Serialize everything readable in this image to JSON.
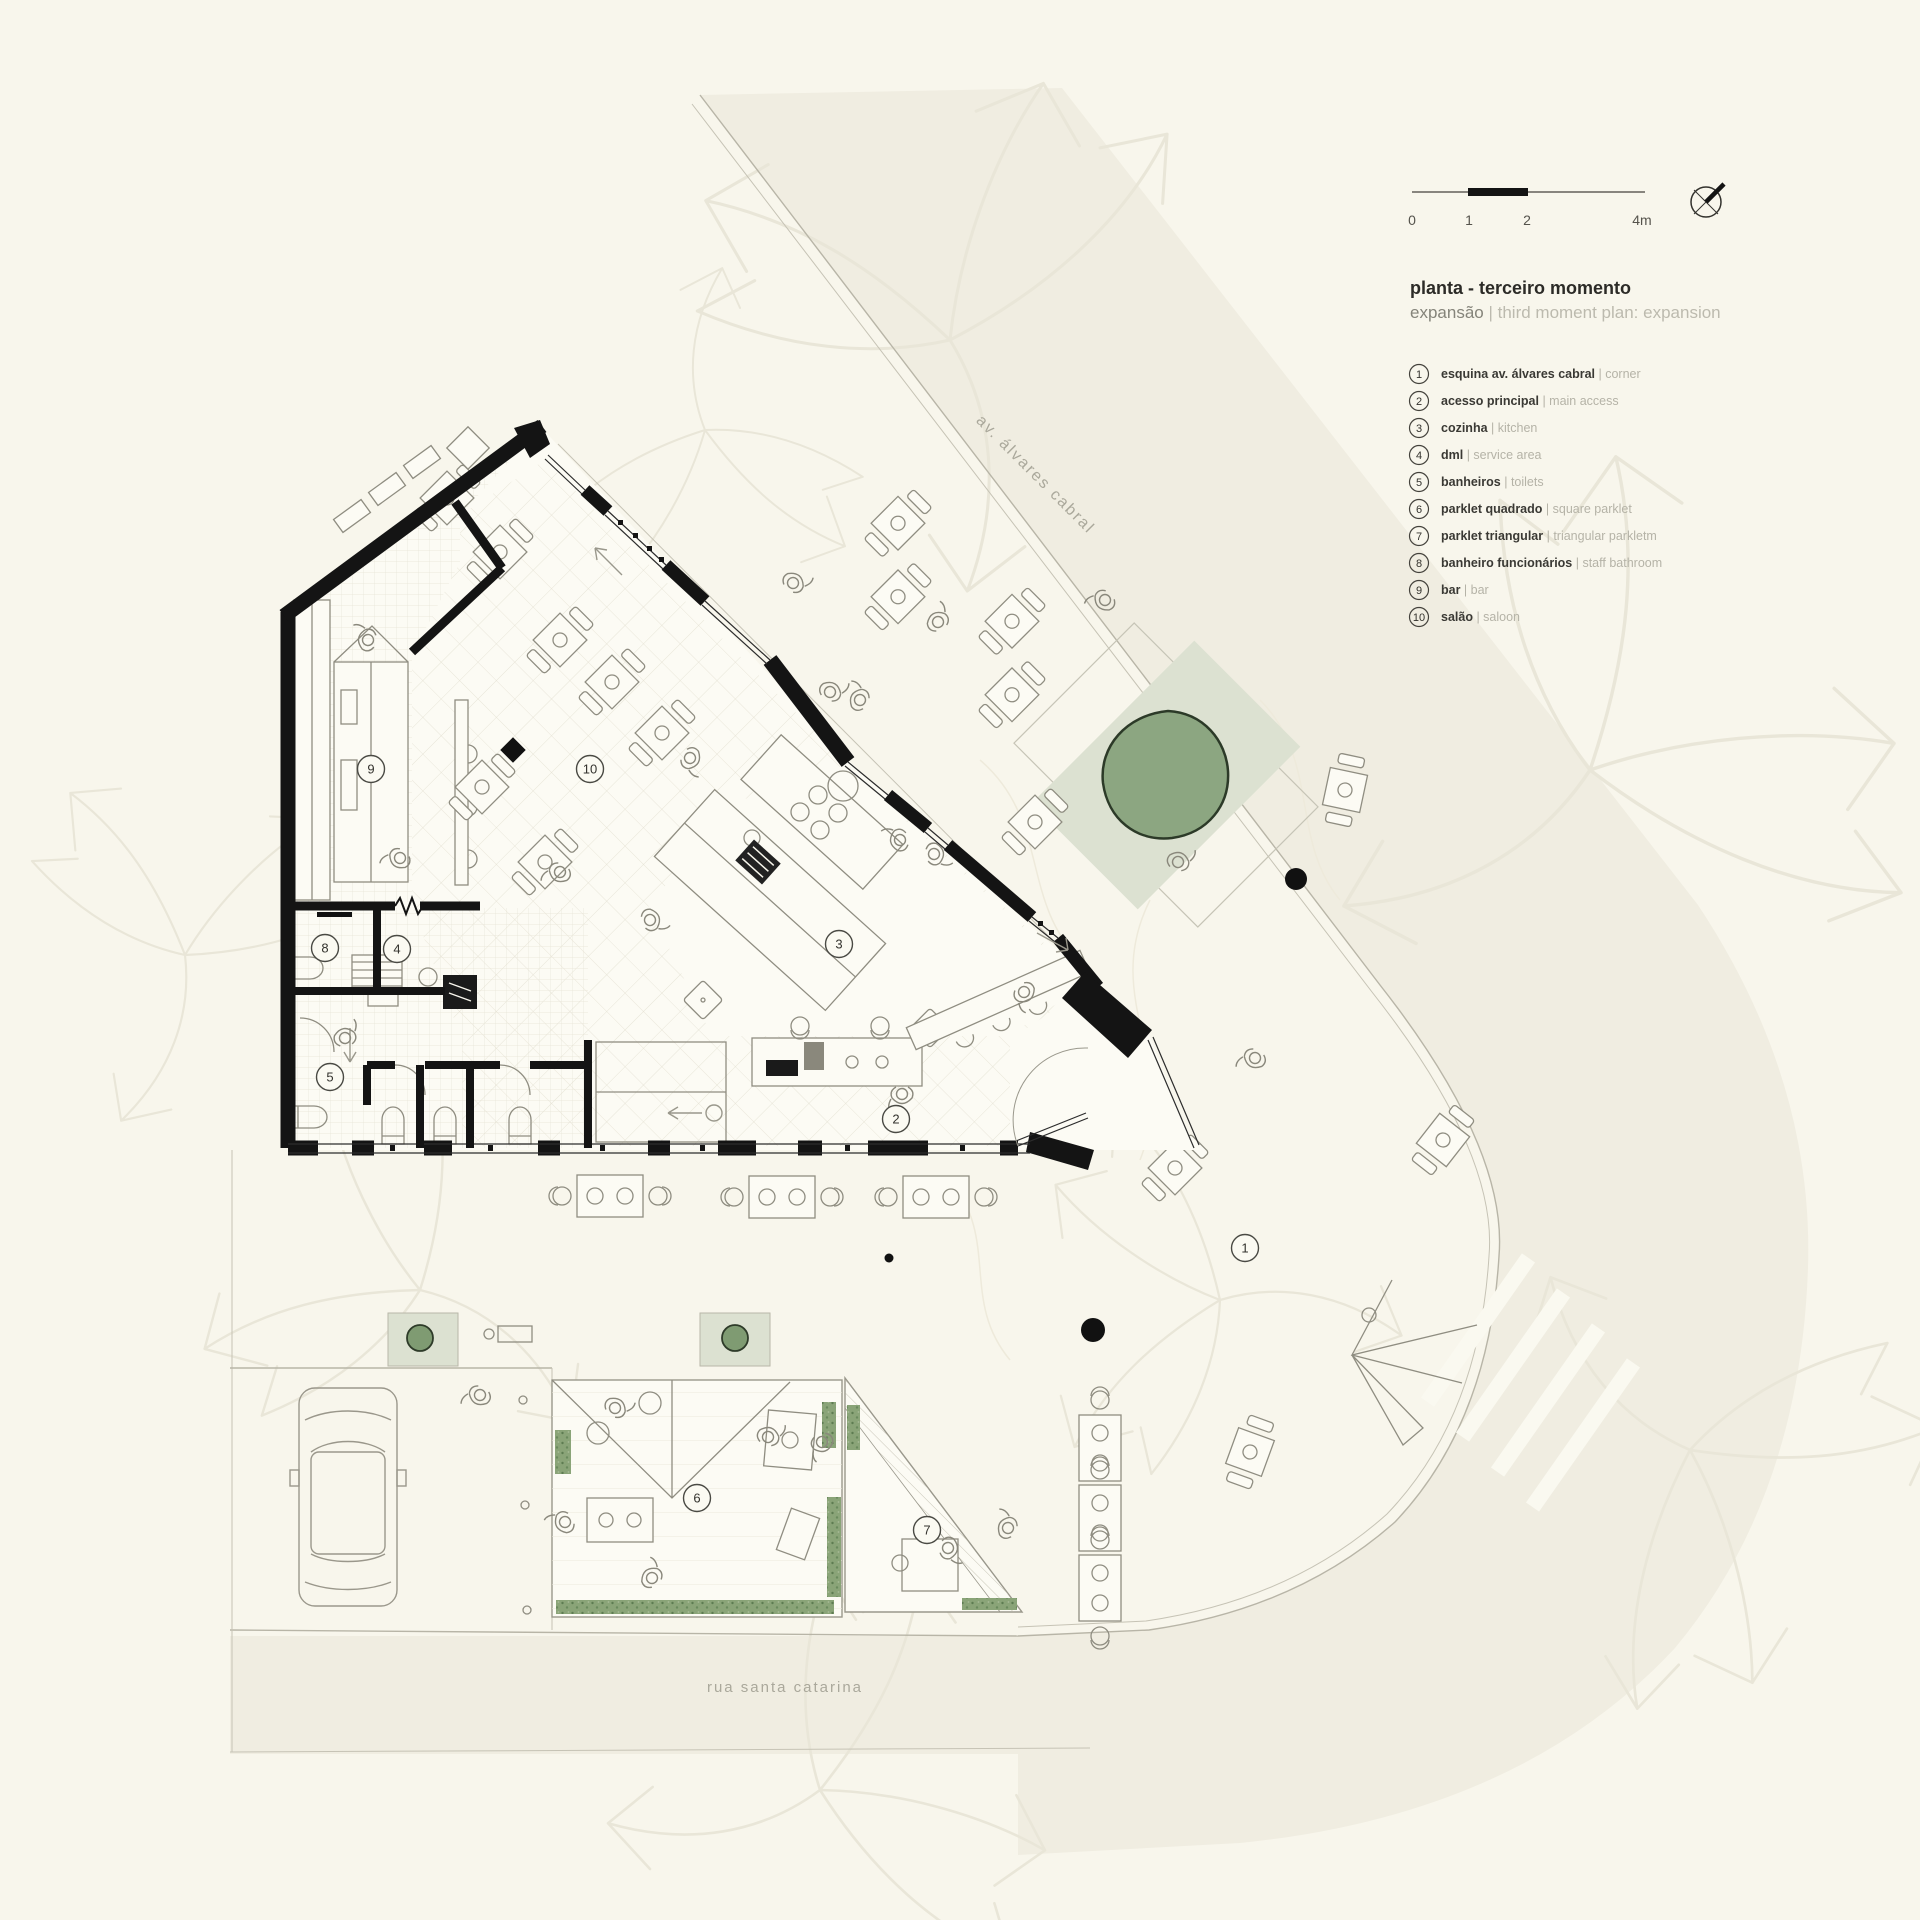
{
  "title_block": {
    "title": "planta - terceiro momento",
    "subtitle_pt": "expansão",
    "subtitle_sep": " | ",
    "subtitle_en": "third moment plan: expansion"
  },
  "scale_bar": {
    "labels": [
      "0",
      "1",
      "2",
      "4m"
    ]
  },
  "compass": {
    "name": "north-indicator"
  },
  "streets": {
    "avenue": "av. álvares cabral",
    "street": "rua santa catarina"
  },
  "legend": {
    "items": [
      {
        "num": "1",
        "pt": "esquina av. álvares cabral",
        "en": "corner"
      },
      {
        "num": "2",
        "pt": "acesso principal",
        "en": "main access"
      },
      {
        "num": "3",
        "pt": "cozinha",
        "en": "kitchen"
      },
      {
        "num": "4",
        "pt": "dml",
        "en": "service area"
      },
      {
        "num": "5",
        "pt": "banheiros",
        "en": "toilets"
      },
      {
        "num": "6",
        "pt": "parklet quadrado",
        "en": "square parklet"
      },
      {
        "num": "7",
        "pt": "parklet triangular",
        "en": "triangular parkletm"
      },
      {
        "num": "8",
        "pt": "banheiro funcionários",
        "en": "staff bathroom"
      },
      {
        "num": "9",
        "pt": "bar",
        "en": "bar"
      },
      {
        "num": "10",
        "pt": "salão",
        "en": "saloon"
      }
    ]
  },
  "plan_markers": [
    {
      "num": "1",
      "x": 1245,
      "y": 1248
    },
    {
      "num": "2",
      "x": 896,
      "y": 1119
    },
    {
      "num": "3",
      "x": 839,
      "y": 944
    },
    {
      "num": "4",
      "x": 397,
      "y": 949
    },
    {
      "num": "5",
      "x": 330,
      "y": 1077
    },
    {
      "num": "6",
      "x": 697,
      "y": 1498
    },
    {
      "num": "7",
      "x": 927,
      "y": 1530
    },
    {
      "num": "8",
      "x": 325,
      "y": 948
    },
    {
      "num": "9",
      "x": 371,
      "y": 769
    },
    {
      "num": "10",
      "x": 590,
      "y": 769
    }
  ],
  "colors": {
    "background": "#f8f6ec",
    "road": "#f0ede1",
    "tree_green": "#8ca681",
    "plot_green": "#dce1d1",
    "vegetation_green": "#8aa478",
    "wall_black": "#141414"
  }
}
